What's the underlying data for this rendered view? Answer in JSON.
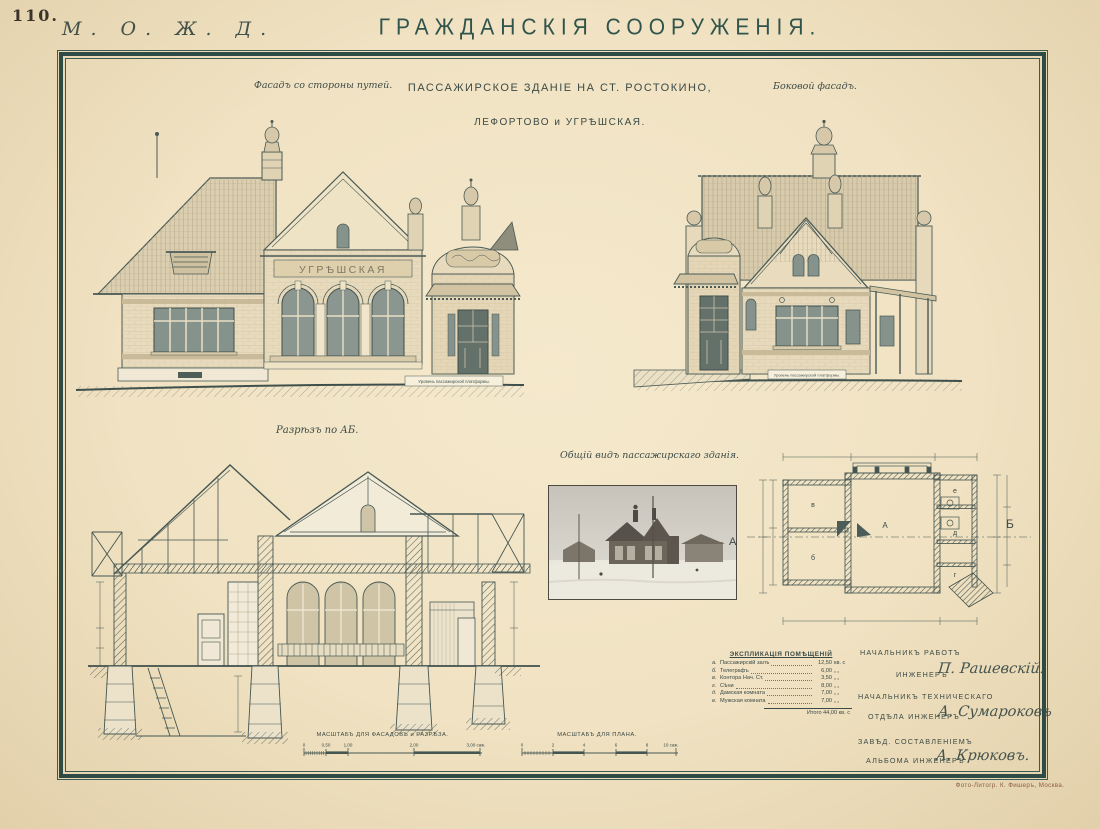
{
  "page": {
    "plate_number": "110.",
    "railway_mark": "М. О. Ж. Д.",
    "title": "ГРАЖДАНСКІЯ СООРУЖЕНІЯ.",
    "imprint": "Фото-Литогр. К. Фишеръ, Москва."
  },
  "headings": {
    "front_facade": "Фасадъ со стороны путей.",
    "subject_line1": "ПАССАЖИРСКОЕ ЗДАНІЕ НА СТ. РОСТОКИНО,",
    "subject_line2": "ЛЕФОРТОВО и УГРѢШСКАЯ.",
    "side_facade": "Боковой фасадъ.",
    "section": "Разрѣзъ по АБ.",
    "general_view": "Общій видъ пассажирскаго зданія."
  },
  "facade": {
    "station_sign": "УГРѢШСКАЯ",
    "platform_level": "Уровень пассажирской платформы."
  },
  "plan": {
    "marker_a": "А",
    "marker_b": "Б",
    "rooms": {
      "hall": "А",
      "room_b": "б",
      "room_v": "в",
      "room_g": "г",
      "room_d": "д",
      "room_e": "е"
    }
  },
  "explication": {
    "title": "ЭКСПЛИКАЦІЯ ПОМѢЩЕНІЙ",
    "rows": [
      {
        "idx": "а.",
        "name": "Пассажирскій залъ",
        "value": "12,50",
        "unit": "кв. с"
      },
      {
        "idx": "б.",
        "name": "Телеграфъ",
        "value": "6,00",
        "unit": "„  „"
      },
      {
        "idx": "в.",
        "name": "Контора Нач. Ст.",
        "value": "3,50",
        "unit": "„  „"
      },
      {
        "idx": "г.",
        "name": "Сѣни",
        "value": "8,00",
        "unit": "„  „"
      },
      {
        "idx": "д.",
        "name": "Дамская комната",
        "value": "7,00",
        "unit": "„  „"
      },
      {
        "idx": "е.",
        "name": "Мужская комната",
        "value": "7,00",
        "unit": "„  „"
      }
    ],
    "total": "Итого 44,00 кв. с"
  },
  "scales": {
    "facades": "МАСШТАБЪ ДЛЯ ФАСАДОВЪ и РАЗРѢЗА.",
    "plan": "МАСШТАБЪ ДЛЯ ПЛАНА.",
    "facade_ticks": [
      "0",
      "0,50",
      "1,00",
      "2,00",
      "3,00 саж."
    ],
    "plan_ticks": [
      "0",
      "2",
      "4",
      "6",
      "8",
      "10 саж."
    ]
  },
  "signatures": [
    {
      "line1": "НАЧАЛЬНИКЪ РАБОТЪ",
      "line2": "ИНЖЕНЕРЪ",
      "name": "П. Рашевскій."
    },
    {
      "line1": "НАЧАЛЬНИКЪ ТЕХНИЧЕСКАГО",
      "line2": "ОТДѢЛА ИНЖЕНЕРЪ",
      "name": "А. Сумароковъ"
    },
    {
      "line1": "ЗАВѢД. СОСТАВЛЕНІЕМЪ",
      "line2": "АЛЬБОМА ИНЖЕНЕРЪ",
      "name": "А. Крюковъ."
    }
  ],
  "colors": {
    "paper": "#f0e2c2",
    "ink": "#455652",
    "frame": "#2e4b45",
    "imprint": "#8c5a46"
  }
}
